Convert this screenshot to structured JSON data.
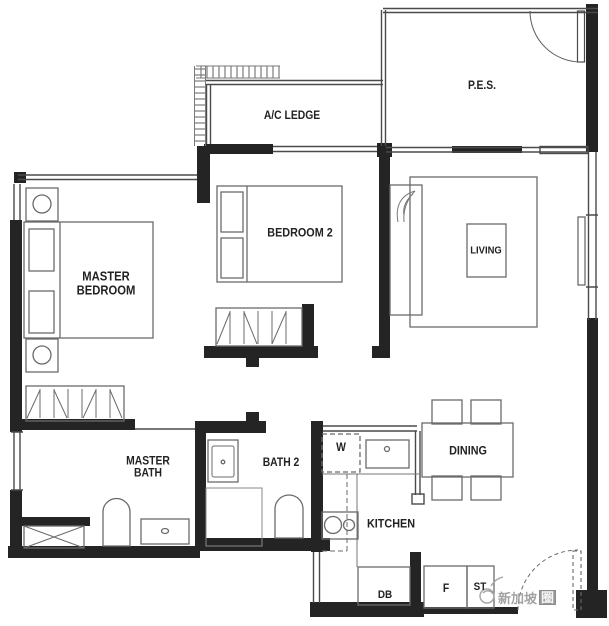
{
  "rooms": {
    "master_bedroom": "MASTER BEDROOM",
    "bedroom_2": "BEDROOM 2",
    "living": "LIVING",
    "pes": "P.E.S.",
    "ac_ledge": "A/C LEDGE",
    "master_bath": "MASTER BATH",
    "bath_2": "BATH 2",
    "dining": "DINING",
    "kitchen": "KITCHEN"
  },
  "fixtures": {
    "washer": "W",
    "distribution_board": "DB",
    "fridge": "F",
    "store": "ST"
  },
  "watermark": {
    "text_main": "新加坡",
    "text_badge": "圈"
  },
  "colors": {
    "wall": "#242424",
    "thin_line": "#4a4a4a",
    "furniture_line": "#6b6b6b",
    "watermark": "#9a9a9a",
    "background": "#ffffff"
  }
}
